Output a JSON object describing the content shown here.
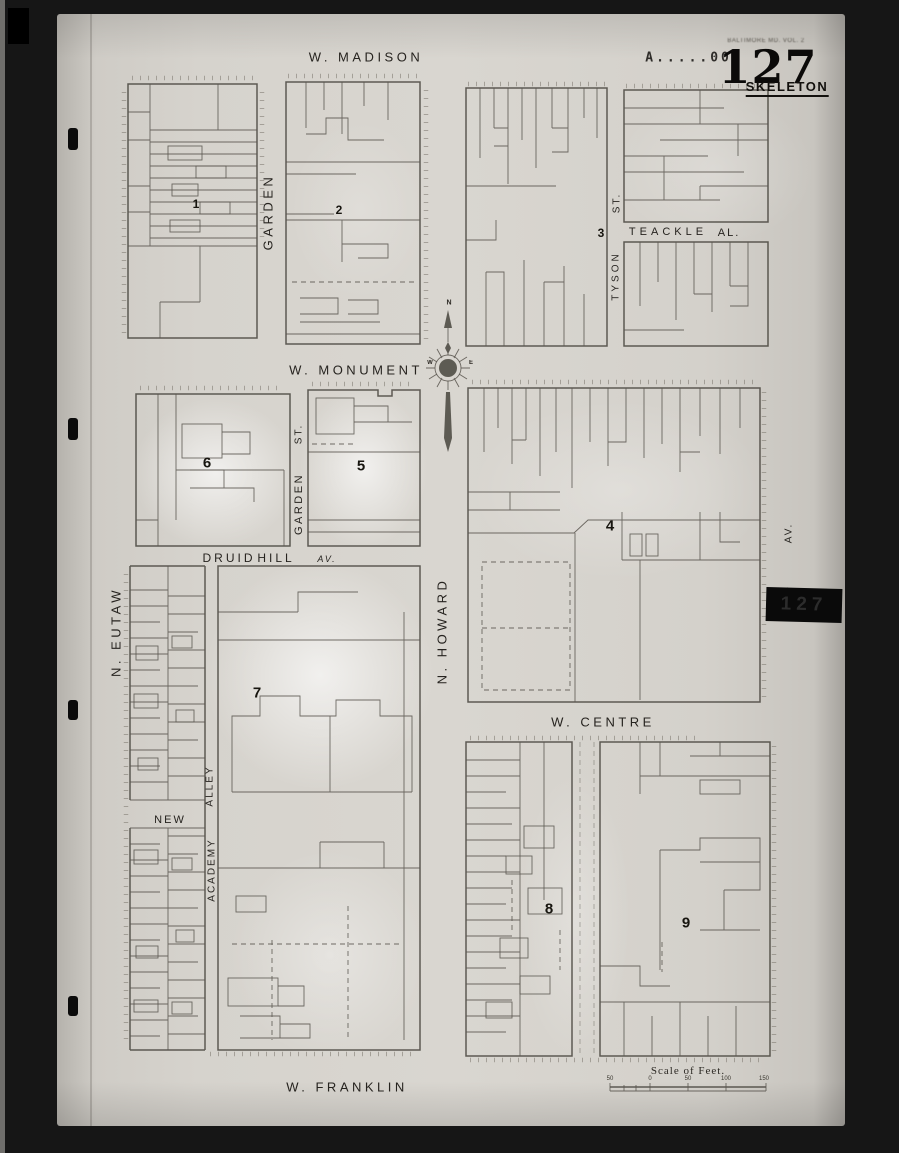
{
  "sheet": {
    "number": "127",
    "type_label": "SKELETON",
    "header_note": "BALTIMORE MD. VOL. 2",
    "stamp": "A.....002",
    "tab_number": "127"
  },
  "streets": {
    "w_madison": "W. MADISON",
    "w_monument": "W. MONUMENT",
    "w_centre": "W. CENTRE",
    "w_franklin": "W. FRANKLIN",
    "n_eutaw": "N. EUTAW",
    "n_howard": "N. HOWARD",
    "garden_upper": "GARDEN",
    "garden_lower": "GARDEN",
    "garden_lower_st": "ST.",
    "tyson": "TYSON",
    "tyson_st": "ST.",
    "teackle": "TEACKLE",
    "teackle_al": "AL.",
    "druid": "DRUID",
    "hill": "HILL",
    "druid_av": "AV.",
    "new_street": "NEW",
    "academy": "ACADEMY",
    "alley": "ALLEY",
    "park_av_rk": "RK",
    "park_av_av": "AV."
  },
  "blocks": {
    "b1": "1",
    "b2": "2",
    "b3": "3",
    "b4": "4",
    "b5": "5",
    "b6": "6",
    "b7": "7",
    "b8": "8",
    "b9": "9"
  },
  "compass": {
    "n": "N",
    "w": "W",
    "e": "E"
  },
  "scale_bar": {
    "title": "Scale of Feet.",
    "ticks": [
      "50",
      "0",
      "50",
      "100",
      "150"
    ]
  }
}
